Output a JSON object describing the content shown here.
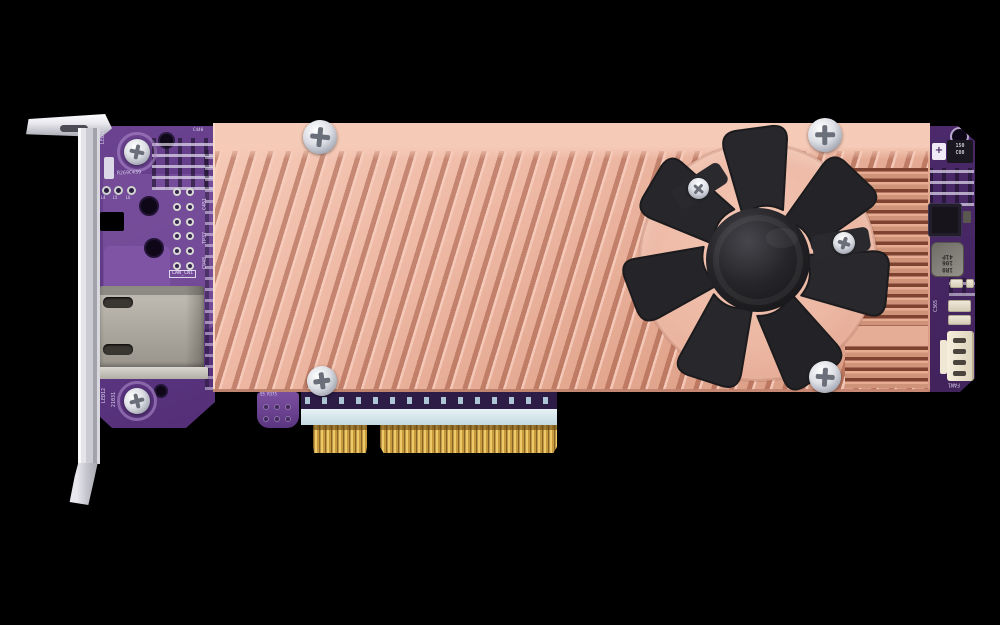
{
  "image": {
    "kind": "product-photo",
    "subject": "Low-profile PCIe expansion card with copper heatsink, cooling fan, LAN port and PCIe x8 edge connector",
    "background_color": "#000000"
  },
  "colors": {
    "heatsink_copper": "#eab4a0",
    "pcb_purple": "#5c3480",
    "fan_black": "#232327",
    "bracket_silver": "#d8d8de",
    "gold_fingers": "#d9b452",
    "port_grey": "#aba79e"
  },
  "silkscreen": {
    "led11": "LED11",
    "r269": "R269C439",
    "c440": "C440",
    "l4": "L4",
    "l5": "L5",
    "l6": "L6",
    "lan_cn1": "LAN_CN1",
    "c451": "C451",
    "tp37": "TP37",
    "c948": "C948",
    "led12": "LED12",
    "serial": "21031",
    "tab_label": "SS R375",
    "cap_value": "150",
    "cap_code": "C08",
    "cap_plus": "+",
    "ind1": "1R0",
    "ind2": "106",
    "ind3": "41P",
    "c365": "C365",
    "fan1": "FAN1"
  }
}
